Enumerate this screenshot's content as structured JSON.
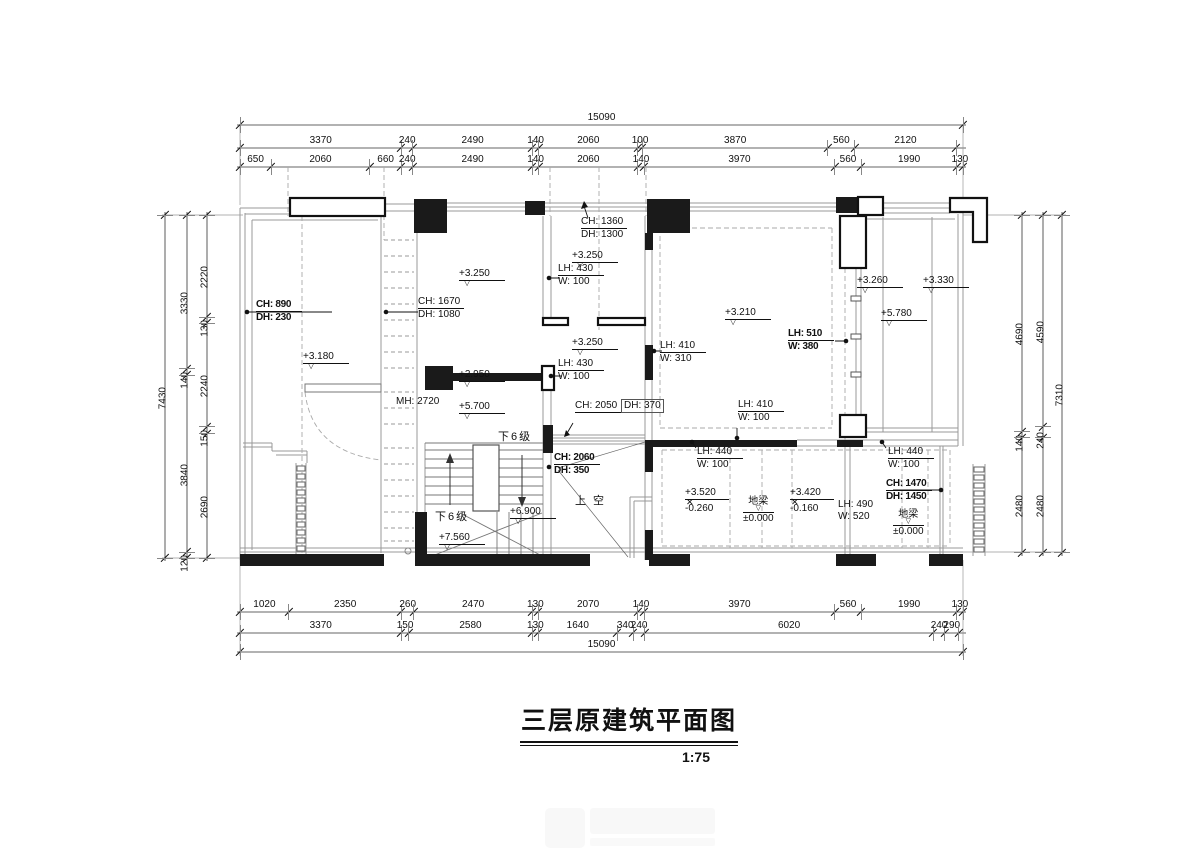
{
  "title": {
    "text": "三层原建筑平面图",
    "scale": "1:75"
  },
  "dimensions": {
    "top": {
      "total": "15090",
      "row1": [
        "3370",
        "240",
        "2490",
        "140",
        "2060",
        "100",
        "3870",
        "560",
        "2120"
      ],
      "row2": [
        "650",
        "2060",
        "660",
        "240",
        "2490",
        "140",
        "2060",
        "140",
        "3970",
        "560",
        "1990",
        "130"
      ]
    },
    "bottom": {
      "row1": [
        "1020",
        "2350",
        "260",
        "2470",
        "130",
        "2070",
        "140",
        "3970",
        "560",
        "1990",
        "130"
      ],
      "row2": [
        "3370",
        "150",
        "2580",
        "130",
        "1640",
        "340",
        "240",
        "6020",
        "240",
        "290"
      ],
      "total": "15090"
    },
    "left": {
      "outer": "7430",
      "mid": [
        "3330",
        "140",
        "3840",
        "120"
      ],
      "inner": [
        "2220",
        "130",
        "2240",
        "150",
        "2690"
      ]
    },
    "right": {
      "inner": [
        "4690",
        "140",
        "2480"
      ],
      "mid": [
        "4590",
        "240",
        "2480"
      ],
      "outer": "7310"
    }
  },
  "annotations": {
    "ch890": {
      "l1": "CH: 890",
      "l2": "DH: 230"
    },
    "ch1670": {
      "l1": "CH: 1670",
      "l2": "DH: 1080"
    },
    "ch1360": {
      "l1": "CH: 1360",
      "l2": "DH: 1300"
    },
    "lh430a": {
      "l1": "LH: 430",
      "l2": "W:  100"
    },
    "lh430b": {
      "l1": "LH: 430",
      "l2": "W:  100"
    },
    "lh410a": {
      "l1": "LH: 410",
      "l2": "W:  310"
    },
    "lh410b": {
      "l1": "LH: 410",
      "l2": "W:  100"
    },
    "lh510": {
      "l1": "LH: 510",
      "l2": "W:  380"
    },
    "ch2050": {
      "l1": "CH: 2050",
      "l2": "DH:  370"
    },
    "ch2060": {
      "l1": "CH: 2060",
      "l2": "DH:  350"
    },
    "lh440a": {
      "l1": "LH: 440",
      "l2": "W:  100"
    },
    "lh440b": {
      "l1": "LH: 440",
      "l2": "W:  100"
    },
    "ch1470": {
      "l1": "CH: 1470",
      "l2": "DH: 1450"
    },
    "lh490": {
      "l1": "LH: 490",
      "l2": "W:  520"
    },
    "mh2720": {
      "l1": "MH: 2720"
    },
    "down6_upper": "下6级",
    "down6_lower": "下6级",
    "void_label": "上 空",
    "dl1": {
      "t": "地梁",
      "b": "±0.000"
    },
    "dl2": {
      "t": "地梁",
      "b": "±0.000"
    }
  },
  "levels": {
    "v3180": "+3.180",
    "v3250a": "+3.250",
    "v3250b": "+3.250",
    "v3250c": "+3.250",
    "v3210": "+3.210",
    "v3260": "+3.260",
    "v3330": "+3.330",
    "v5780": "+5.780",
    "v2950": "+2.950",
    "v5700": "+5.700",
    "v6900": "+6.900",
    "v7560": "+7.560",
    "l3520": {
      "t": "+3.520",
      "b": "-0.260"
    },
    "l3420": {
      "t": "+3.420",
      "b": "-0.160"
    }
  }
}
